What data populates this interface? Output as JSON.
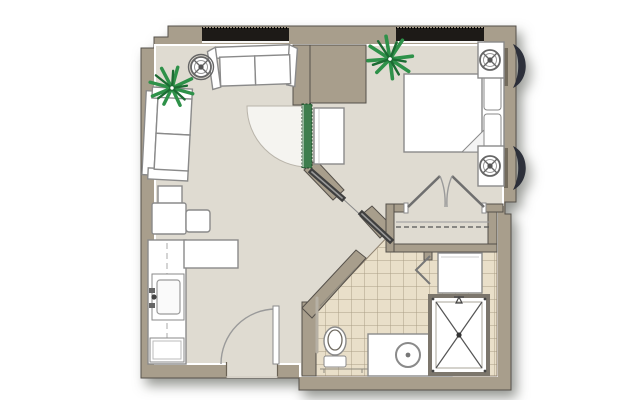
{
  "colors": {
    "background": "#ffffff",
    "wall": "#a89e8c",
    "wall_outline": "#55504a",
    "floor": "#dfdbd1",
    "tile": "#e9dfc9",
    "tile_grout": "#9b8e76",
    "window": "#1d1a17",
    "door_green": "#3e7d4d",
    "door_green_dark": "#1f4527",
    "furniture_fill": "#ffffff",
    "furniture_outline": "#8a8a8a",
    "plant_green": "#2e9149",
    "plant_green_dark": "#1c6b33",
    "awning": "#252834",
    "slider_dark": "#3f3f3f",
    "slider_light": "#9a9a9a",
    "arc_line": "#9a9a9a",
    "fixture_line": "#6f6a60"
  },
  "floor_plan": {
    "depicted_rooms": [
      "living-room",
      "kitchen",
      "bedroom",
      "closet",
      "bathroom",
      "entry"
    ],
    "depicted_elements": [
      "sofa",
      "loveseat",
      "armchair",
      "side-table",
      "ottoman",
      "floor-lamp",
      "potted-plant",
      "kitchen-counter",
      "kitchen-sink",
      "kitchen-peninsula",
      "appliance",
      "entry-door",
      "interior-door-green",
      "door-swing-arc",
      "dresser",
      "bed",
      "pillows",
      "folded-blanket-corner",
      "nightstand",
      "table-lamp",
      "window",
      "exterior-awning",
      "closet-double-doors",
      "closet-shelf-and-rod",
      "sliding-door-panels",
      "tiled-bathroom-floor",
      "toilet",
      "grab-bars",
      "vanity-with-round-sink",
      "shower-with-x",
      "linen-cabinet",
      "bifold-door"
    ]
  }
}
